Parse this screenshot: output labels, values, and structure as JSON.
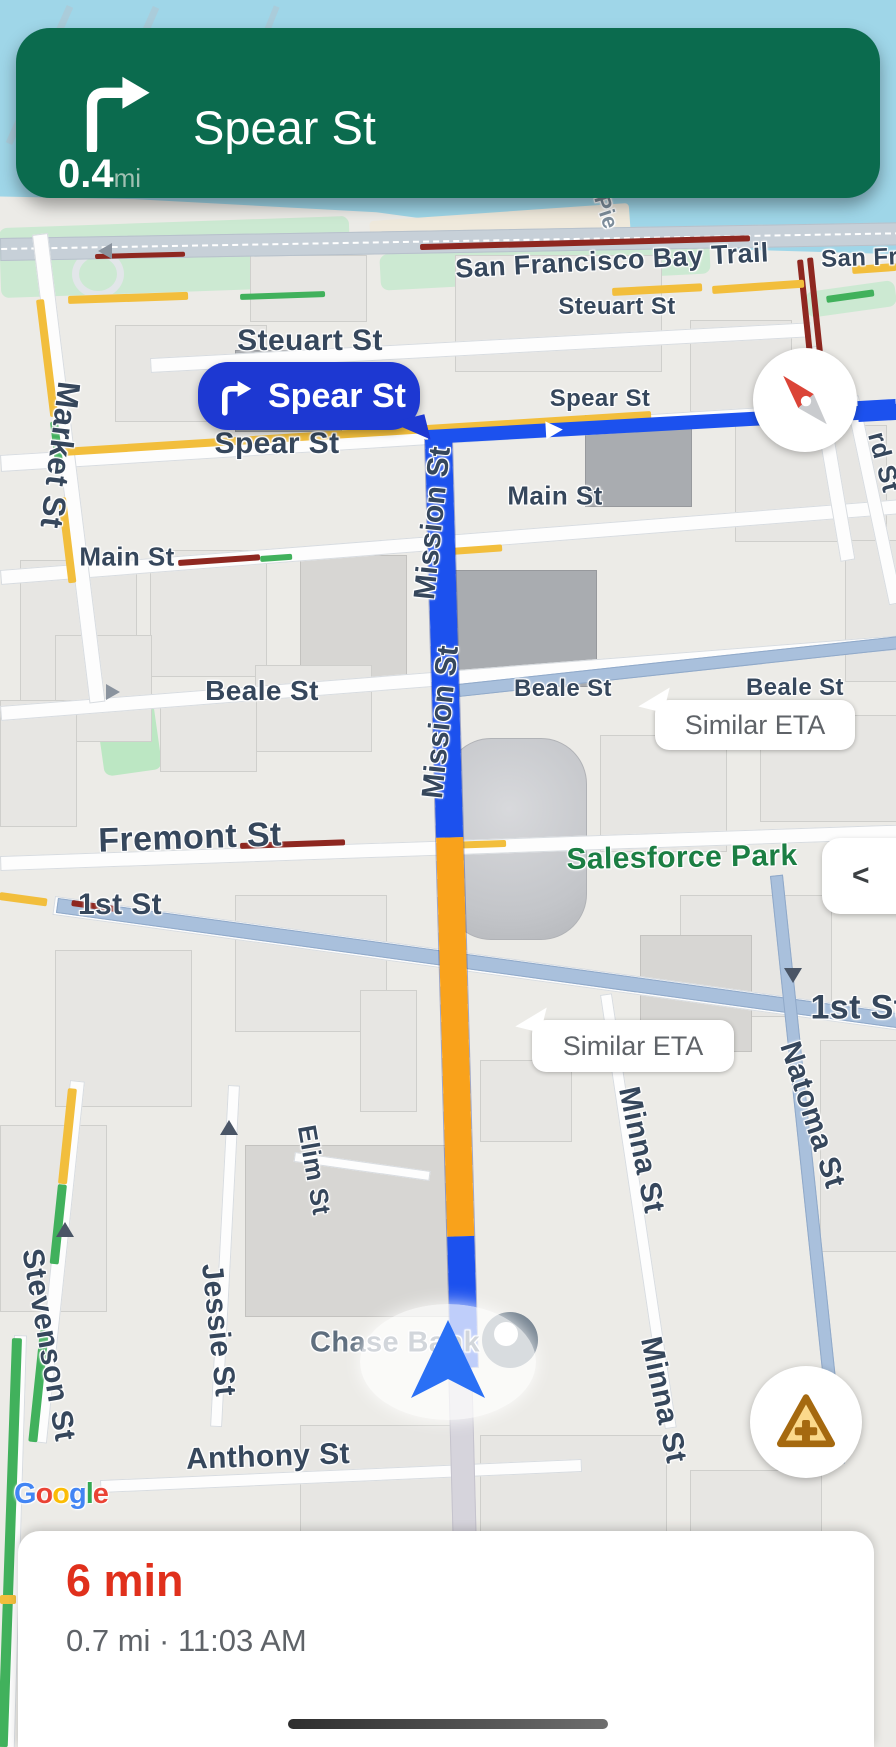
{
  "banner": {
    "distance": "0.4",
    "unit": "mi",
    "street": "Spear St",
    "maneuver": "turn-right-icon"
  },
  "turn_callout": {
    "street": "Spear St"
  },
  "eta_callouts": [
    {
      "text": "Similar ETA"
    },
    {
      "text": "Similar ETA"
    }
  ],
  "bottom_sheet": {
    "eta": "6 min",
    "details": "0.7 mi · 11:03 AM"
  },
  "controls": {
    "overview_chevron": "<"
  },
  "google_logo": [
    {
      "c": "G",
      "color": "#4285F4"
    },
    {
      "c": "o",
      "color": "#EA4335"
    },
    {
      "c": "o",
      "color": "#FBBC05"
    },
    {
      "c": "g",
      "color": "#4285F4"
    },
    {
      "c": "l",
      "color": "#34A853"
    },
    {
      "c": "e",
      "color": "#EA4335"
    }
  ],
  "colors": {
    "banner_green": "#0B6B4E",
    "route_blue": "#1C51EE",
    "route_orange": "#F9A21B",
    "alt_route": "#A9C0DC",
    "traffic_red": "#8E2720",
    "traffic_yellow": "#F2BE3C",
    "traffic_green": "#41B15C",
    "eta_red": "#E0301C",
    "water": "#9FD6E8",
    "callout_blue": "#1D38D2",
    "park_green_label": "#1B7E43"
  },
  "street_labels": [
    {
      "text": "San Francisco Bay Trail",
      "x": 612,
      "y": 261,
      "size": 27,
      "rot": -3
    },
    {
      "text": "San Fran",
      "x": 874,
      "y": 258,
      "size": 24,
      "rot": -2
    },
    {
      "text": "Pie",
      "x": 606,
      "y": 212,
      "size": 22,
      "rot": 72,
      "color": "#7E8E9C"
    },
    {
      "text": "Market St",
      "x": 60,
      "y": 455,
      "size": 32,
      "rot": 97
    },
    {
      "text": "Steuart St",
      "x": 310,
      "y": 341,
      "size": 30,
      "rot": 0
    },
    {
      "text": "Steuart St",
      "x": 617,
      "y": 307,
      "size": 24,
      "rot": 0
    },
    {
      "text": "Spear St",
      "x": 277,
      "y": 444,
      "size": 30,
      "rot": 0
    },
    {
      "text": "Spear St",
      "x": 600,
      "y": 399,
      "size": 24,
      "rot": 0
    },
    {
      "text": "Main St",
      "x": 127,
      "y": 557,
      "size": 26,
      "rot": 0
    },
    {
      "text": "Main St",
      "x": 555,
      "y": 496,
      "size": 26,
      "rot": 0
    },
    {
      "text": "Beale St",
      "x": 262,
      "y": 691,
      "size": 28,
      "rot": 0
    },
    {
      "text": "Beale St",
      "x": 563,
      "y": 689,
      "size": 24,
      "rot": 0
    },
    {
      "text": "Beale St",
      "x": 795,
      "y": 688,
      "size": 24,
      "rot": 0
    },
    {
      "text": "Fremont St",
      "x": 190,
      "y": 838,
      "size": 34,
      "rot": -2
    },
    {
      "text": "1st St",
      "x": 120,
      "y": 905,
      "size": 30,
      "rot": 0
    },
    {
      "text": "1st St",
      "x": 858,
      "y": 1008,
      "size": 34,
      "rot": 0
    },
    {
      "text": "Mission St",
      "x": 433,
      "y": 523,
      "size": 30,
      "rot": -84
    },
    {
      "text": "Mission St",
      "x": 441,
      "y": 722,
      "size": 30,
      "rot": -84
    },
    {
      "text": "Natoma St",
      "x": 812,
      "y": 1115,
      "size": 30,
      "rot": 72
    },
    {
      "text": "Minna St",
      "x": 641,
      "y": 1150,
      "size": 30,
      "rot": 78
    },
    {
      "text": "Minna St",
      "x": 663,
      "y": 1400,
      "size": 30,
      "rot": 78
    },
    {
      "text": "Elim St",
      "x": 314,
      "y": 1170,
      "size": 26,
      "rot": 80
    },
    {
      "text": "Jessie St",
      "x": 218,
      "y": 1330,
      "size": 30,
      "rot": 84
    },
    {
      "text": "Stevenson St",
      "x": 48,
      "y": 1345,
      "size": 30,
      "rot": 80
    },
    {
      "text": "Anthony St",
      "x": 268,
      "y": 1457,
      "size": 30,
      "rot": -2
    },
    {
      "text": "rd St",
      "x": 884,
      "y": 462,
      "size": 26,
      "rot": 75
    },
    {
      "text": "Chase Bank",
      "x": 395,
      "y": 1343,
      "size": 29,
      "rot": 0,
      "color": "#5E6E7E"
    },
    {
      "text": "Salesforce Park",
      "x": 682,
      "y": 858,
      "size": 30,
      "rot": -1,
      "color": "#1B7E43"
    }
  ],
  "roads": [
    {
      "x": 0,
      "y": 238,
      "w": 900,
      "h": 21,
      "r": -1,
      "t": "major",
      "dash": true
    },
    {
      "x": 150,
      "y": 358,
      "w": 660,
      "h": 13,
      "r": -3.1,
      "t": "minor"
    },
    {
      "x": 0,
      "y": 455,
      "w": 900,
      "h": 15,
      "r": -3.6,
      "t": "minor"
    },
    {
      "x": 0,
      "y": 570,
      "w": 900,
      "h": 13,
      "r": -4.5,
      "t": "minor"
    },
    {
      "x": 0,
      "y": 706,
      "w": 900,
      "h": 13,
      "r": -4.5,
      "t": "minor"
    },
    {
      "x": 0,
      "y": 856,
      "w": 900,
      "h": 13,
      "r": -2,
      "t": "minor"
    },
    {
      "x": 55,
      "y": 896,
      "w": 850,
      "h": 17,
      "r": 7.8,
      "t": "minor"
    },
    {
      "x": 100,
      "y": 1480,
      "w": 480,
      "h": 11,
      "r": -2.5,
      "t": "minor"
    },
    {
      "x": 295,
      "y": 1152,
      "w": 135,
      "h": 8,
      "r": 8,
      "t": "minor"
    },
    {
      "x": 32,
      "y": 235,
      "w": 14,
      "h": 470,
      "r": -7,
      "t": "minor"
    },
    {
      "x": 804,
      "y": 348,
      "w": 13,
      "h": 215,
      "r": -9.7,
      "t": "minor"
    },
    {
      "x": 845,
      "y": 398,
      "w": 12,
      "h": 210,
      "r": -12,
      "t": "minor"
    },
    {
      "x": 228,
      "y": 1085,
      "w": 10,
      "h": 340,
      "r": 3,
      "t": "minor"
    },
    {
      "x": 70,
      "y": 1080,
      "w": 13,
      "h": 362,
      "r": 6,
      "t": "minor"
    },
    {
      "x": 600,
      "y": 995,
      "w": 10,
      "h": 437,
      "r": -8.5,
      "t": "minor"
    },
    {
      "x": 14,
      "y": 1335,
      "w": 11,
      "h": 412,
      "r": 1.7,
      "t": "minor"
    },
    {
      "x": 448,
      "y": 1362,
      "w": 22,
      "h": 385,
      "r": -1.5,
      "t": "south"
    },
    {
      "x": 458,
      "y": 684,
      "w": 445,
      "h": 11,
      "r": -6.2,
      "t": "alt"
    },
    {
      "x": 58,
      "y": 898,
      "w": 848,
      "h": 13,
      "r": 7.8,
      "t": "alt"
    },
    {
      "x": 770,
      "y": 876,
      "w": 11,
      "h": 590,
      "r": -6,
      "t": "alt"
    }
  ],
  "traffic": [
    {
      "x": 420,
      "y": 244,
      "w": 330,
      "h": 6,
      "r": -1.5,
      "c": "#8E2720"
    },
    {
      "x": 95,
      "y": 254,
      "w": 90,
      "h": 5,
      "r": -1.5,
      "c": "#8E2720"
    },
    {
      "x": 797,
      "y": 260,
      "w": 6,
      "h": 95,
      "r": -6,
      "c": "#8E2720"
    },
    {
      "x": 807,
      "y": 258,
      "w": 6,
      "h": 95,
      "r": -6,
      "c": "#8E2720"
    },
    {
      "x": 68,
      "y": 296,
      "w": 120,
      "h": 8,
      "r": -2,
      "c": "#F2BE3C"
    },
    {
      "x": 612,
      "y": 288,
      "w": 90,
      "h": 8,
      "r": -3,
      "c": "#F2BE3C"
    },
    {
      "x": 712,
      "y": 286,
      "w": 92,
      "h": 8,
      "r": -4,
      "c": "#F2BE3C"
    },
    {
      "x": 852,
      "y": 266,
      "w": 44,
      "h": 8,
      "r": -4,
      "c": "#F2BE3C"
    },
    {
      "x": 240,
      "y": 294,
      "w": 85,
      "h": 6,
      "r": -2,
      "c": "#41B15C"
    },
    {
      "x": 826,
      "y": 296,
      "w": 48,
      "h": 7,
      "r": -8,
      "c": "#41B15C"
    },
    {
      "x": 812,
      "y": 355,
      "w": 6,
      "h": 70,
      "r": -9,
      "c": "#41B15C"
    },
    {
      "x": 36,
      "y": 300,
      "w": 8,
      "h": 118,
      "r": -7,
      "c": "#F2BE3C"
    },
    {
      "x": 50,
      "y": 422,
      "w": 8,
      "h": 52,
      "r": -7,
      "c": "#41B15C"
    },
    {
      "x": 58,
      "y": 498,
      "w": 8,
      "h": 86,
      "r": -7,
      "c": "#F2BE3C"
    },
    {
      "x": 62,
      "y": 448,
      "w": 590,
      "h": 8,
      "r": -3.6,
      "c": "#F2BE3C"
    },
    {
      "x": 178,
      "y": 560,
      "w": 82,
      "h": 6,
      "r": -4,
      "c": "#8E2720"
    },
    {
      "x": 260,
      "y": 556,
      "w": 32,
      "h": 6,
      "r": -4,
      "c": "#41B15C"
    },
    {
      "x": 450,
      "y": 548,
      "w": 52,
      "h": 7,
      "r": -4,
      "c": "#F2BE3C"
    },
    {
      "x": 240,
      "y": 843,
      "w": 105,
      "h": 6,
      "r": -2,
      "c": "#8E2720"
    },
    {
      "x": 448,
      "y": 842,
      "w": 58,
      "h": 7,
      "r": -2,
      "c": "#F2BE3C"
    },
    {
      "x": 72,
      "y": 900,
      "w": 46,
      "h": 6,
      "r": 7.8,
      "c": "#8E2720"
    },
    {
      "x": 0,
      "y": 892,
      "w": 48,
      "h": 8,
      "r": 7.8,
      "c": "#F2BE3C"
    },
    {
      "x": 68,
      "y": 1088,
      "w": 9,
      "h": 96,
      "r": 6,
      "c": "#F2BE3C"
    },
    {
      "x": 58,
      "y": 1184,
      "w": 9,
      "h": 80,
      "r": 6,
      "c": "#41B15C"
    },
    {
      "x": 40,
      "y": 1330,
      "w": 9,
      "h": 112,
      "r": 6,
      "c": "#41B15C"
    },
    {
      "x": 12,
      "y": 1338,
      "w": 10,
      "h": 409,
      "r": 2,
      "c": "#41B15C"
    },
    {
      "x": 0,
      "y": 1595,
      "w": 16,
      "h": 9,
      "r": 0,
      "c": "#F2BE3C"
    }
  ],
  "buildings": [
    {
      "x": 115,
      "y": 325,
      "w": 150,
      "h": 95,
      "s": 1
    },
    {
      "x": 250,
      "y": 255,
      "w": 115,
      "h": 65,
      "s": 1
    },
    {
      "x": 455,
      "y": 255,
      "w": 205,
      "h": 115,
      "s": 1
    },
    {
      "x": 690,
      "y": 320,
      "w": 100,
      "h": 90,
      "s": 1
    },
    {
      "x": 585,
      "y": 415,
      "w": 105,
      "h": 90,
      "s": 3
    },
    {
      "x": 735,
      "y": 425,
      "w": 150,
      "h": 115,
      "s": 1
    },
    {
      "x": 235,
      "y": 350,
      "w": 105,
      "h": 80,
      "s": 3
    },
    {
      "x": 20,
      "y": 560,
      "w": 115,
      "h": 160,
      "s": 1
    },
    {
      "x": 150,
      "y": 550,
      "w": 115,
      "h": 125,
      "s": 1
    },
    {
      "x": 300,
      "y": 555,
      "w": 105,
      "h": 125,
      "s": 2
    },
    {
      "x": 450,
      "y": 570,
      "w": 145,
      "h": 115,
      "s": 3
    },
    {
      "x": 255,
      "y": 665,
      "w": 115,
      "h": 85,
      "s": 1
    },
    {
      "x": 55,
      "y": 635,
      "w": 95,
      "h": 105,
      "s": 1
    },
    {
      "x": 0,
      "y": 700,
      "w": 75,
      "h": 125,
      "s": 1
    },
    {
      "x": 160,
      "y": 695,
      "w": 95,
      "h": 75,
      "s": 1
    },
    {
      "x": 600,
      "y": 735,
      "w": 125,
      "h": 115,
      "s": 1
    },
    {
      "x": 760,
      "y": 715,
      "w": 135,
      "h": 105,
      "s": 1
    },
    {
      "x": 680,
      "y": 895,
      "w": 150,
      "h": 120,
      "s": 1
    },
    {
      "x": 640,
      "y": 935,
      "w": 110,
      "h": 115,
      "s": 2
    },
    {
      "x": 235,
      "y": 895,
      "w": 150,
      "h": 135,
      "s": 1
    },
    {
      "x": 55,
      "y": 950,
      "w": 135,
      "h": 155,
      "s": 1
    },
    {
      "x": 0,
      "y": 1125,
      "w": 105,
      "h": 185,
      "s": 1
    },
    {
      "x": 245,
      "y": 1145,
      "w": 205,
      "h": 170,
      "s": 2
    },
    {
      "x": 300,
      "y": 1425,
      "w": 165,
      "h": 105,
      "s": 1
    },
    {
      "x": 480,
      "y": 1435,
      "w": 185,
      "h": 145,
      "s": 1
    },
    {
      "x": 690,
      "y": 1470,
      "w": 130,
      "h": 90,
      "s": 1
    },
    {
      "x": 820,
      "y": 1040,
      "w": 76,
      "h": 210,
      "s": 1
    },
    {
      "x": 845,
      "y": 540,
      "w": 50,
      "h": 140,
      "s": 1
    },
    {
      "x": 360,
      "y": 990,
      "w": 55,
      "h": 120,
      "s": 1
    },
    {
      "x": 480,
      "y": 1060,
      "w": 90,
      "h": 80,
      "s": 1
    }
  ],
  "route": {
    "mission_segments": [
      {
        "color": "#1C51EE",
        "h": 398
      },
      {
        "color": "#F9A21B",
        "h": 399
      },
      {
        "color": "#1C51EE",
        "h": 131
      }
    ]
  },
  "arrows": [
    {
      "x": 56,
      "y": 1222,
      "dir": "up"
    },
    {
      "x": 220,
      "y": 1120,
      "dir": "up"
    },
    {
      "x": 784,
      "y": 968,
      "dir": "down"
    },
    {
      "x": 106,
      "y": 684,
      "dir": "right"
    },
    {
      "x": 98,
      "y": 243,
      "dir": "left"
    }
  ]
}
